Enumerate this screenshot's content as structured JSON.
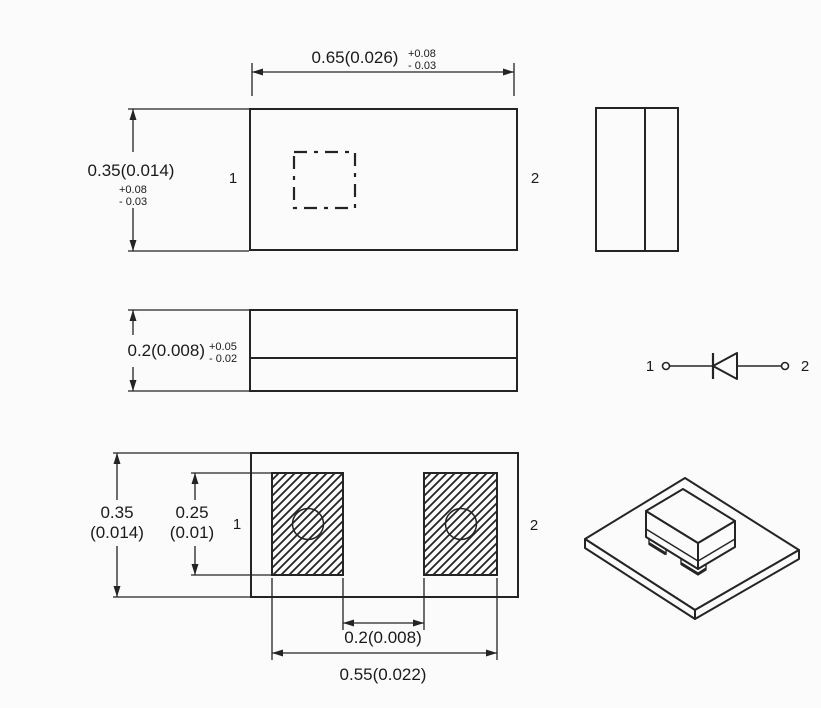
{
  "colors": {
    "background": "#fbfbfb",
    "line": "#242424",
    "text": "#1a1a1a"
  },
  "top_view": {
    "width_dim": {
      "value": "0.65(0.026)",
      "tol_plus": "+0.08",
      "tol_minus": "- 0.03"
    },
    "height_dim": {
      "value": "0.35(0.014)",
      "tol_plus": "+0.08",
      "tol_minus": "- 0.03"
    },
    "pin_left": "1",
    "pin_right": "2"
  },
  "side_view": {
    "thickness_dim": {
      "value": "0.2(0.008)",
      "tol_plus": "+0.05",
      "tol_minus": "- 0.02"
    }
  },
  "bottom_view": {
    "overall_height_dim": {
      "value": "0.35",
      "inches": "(0.014)"
    },
    "pad_height_dim": {
      "value": "0.25",
      "inches": "(0.01)"
    },
    "pad_gap_dim": "0.2(0.008)",
    "pad_span_dim": "0.55(0.022)",
    "pin_left": "1",
    "pin_right": "2"
  },
  "schematic": {
    "pin_left": "1",
    "pin_right": "2"
  }
}
